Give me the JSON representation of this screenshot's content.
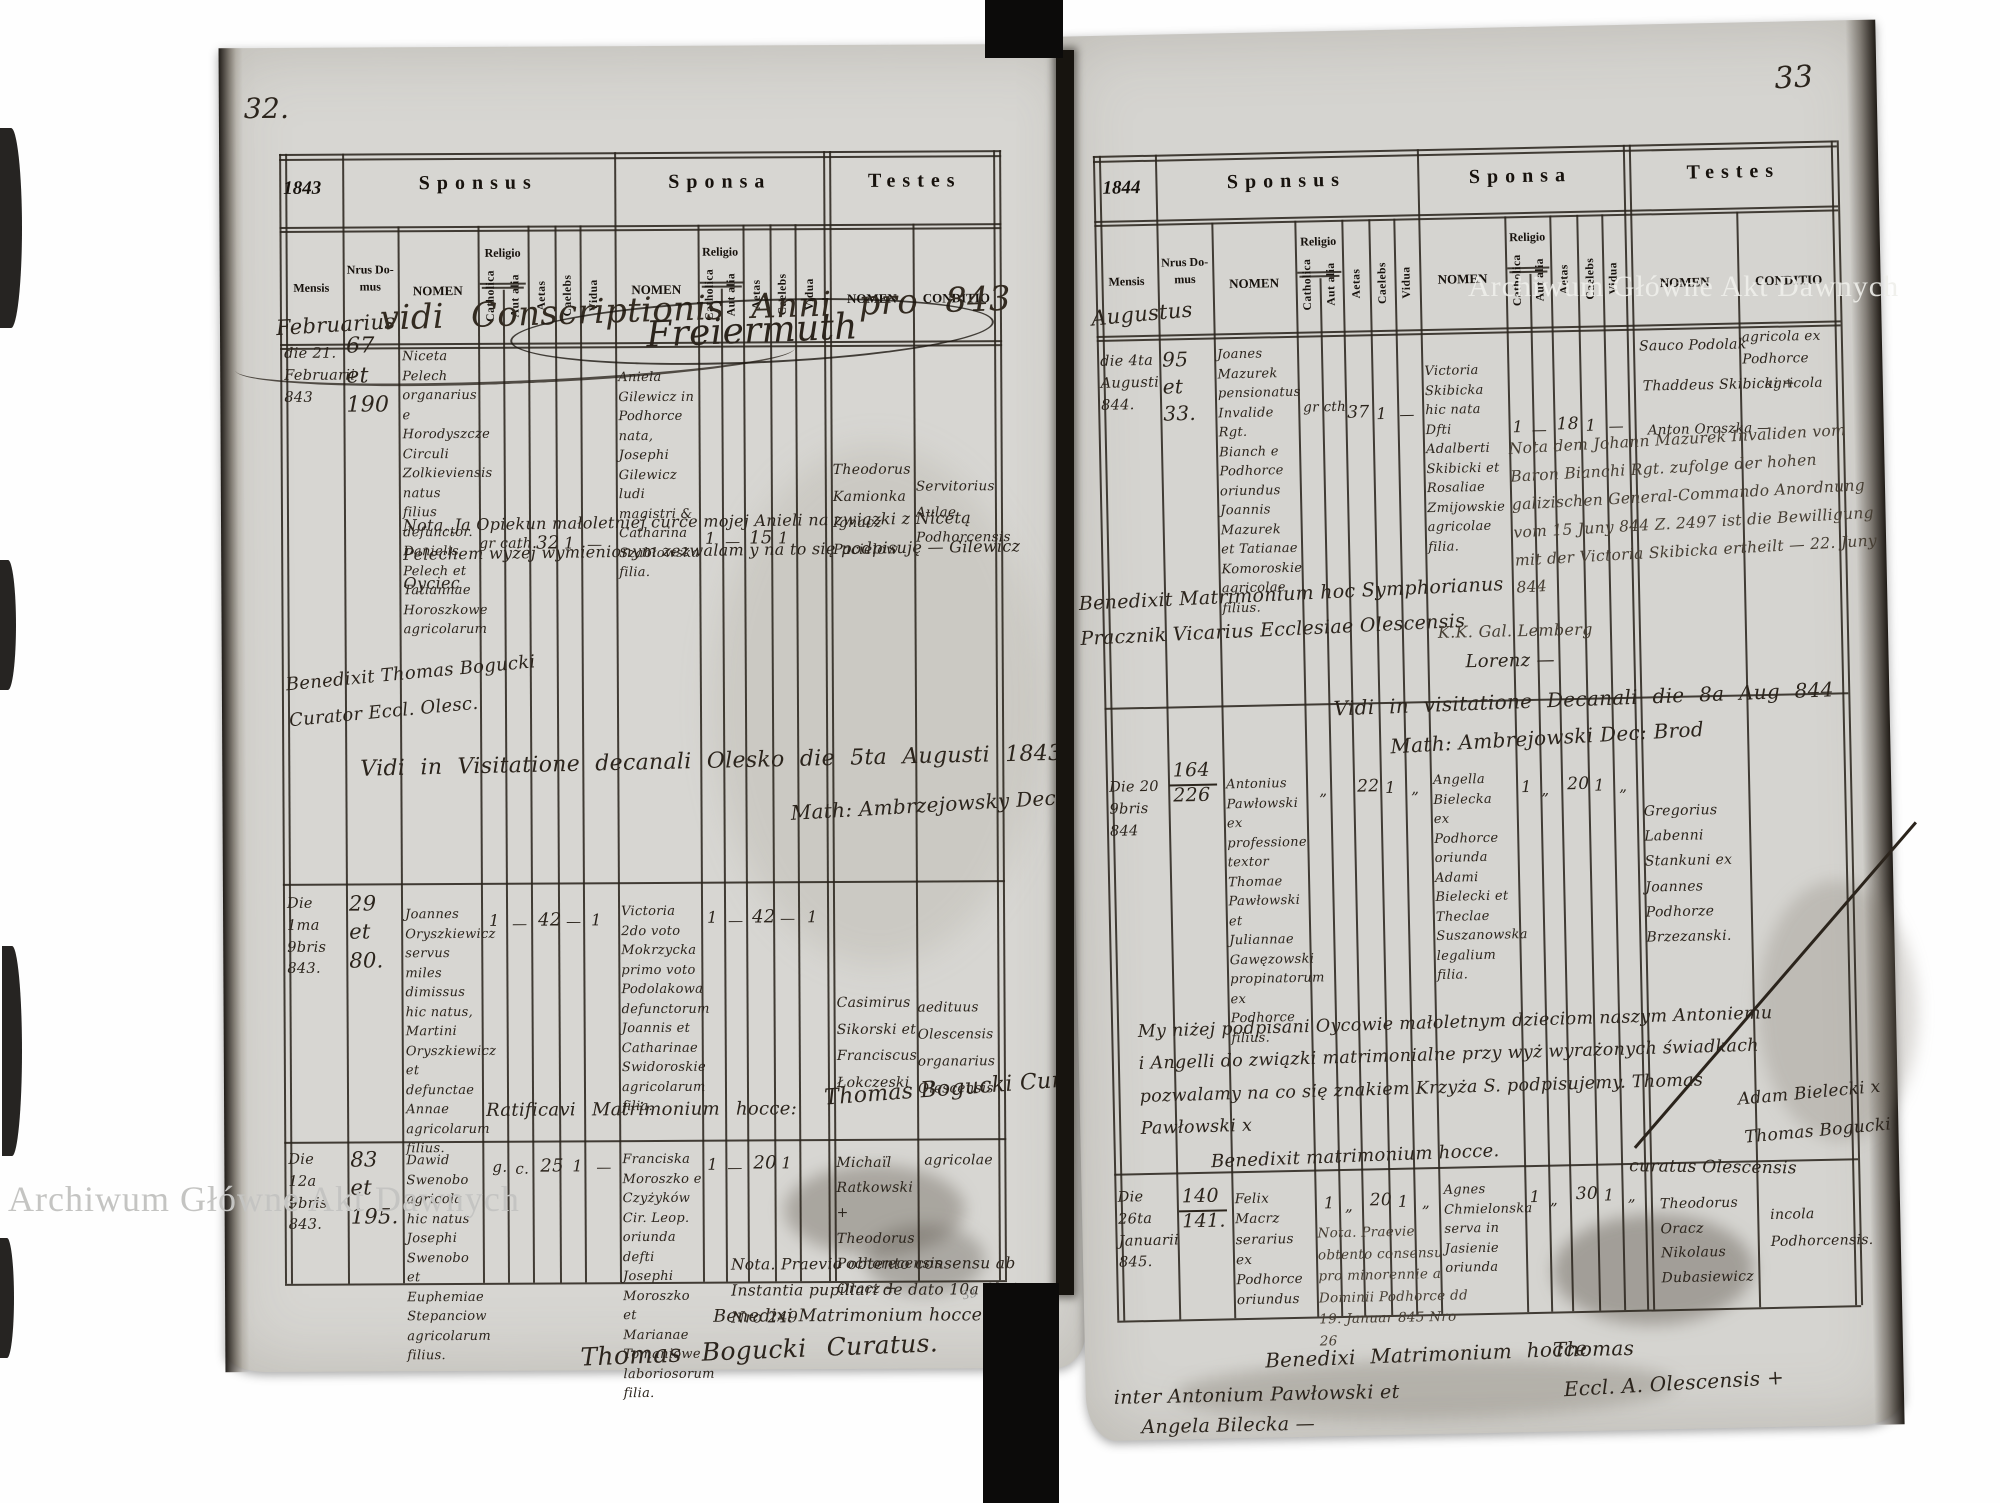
{
  "watermark": "Archiwum Główne Akt Dawnych",
  "pencil_mark": "33",
  "headers": {
    "sponsus": "Sponsus",
    "sponsa": "Sponsa",
    "testes": "Testes",
    "mensis": "Mensis",
    "nrus_domus": "Nrus Do- mus",
    "nomen": "NOMEN",
    "religio": "Religio",
    "catholica": "Catholica",
    "aut_alia": "Aut alia",
    "aetas": "Aetas",
    "caelebs": "Caelebs",
    "vidua": "Vidua",
    "conditio": "CONDITIO"
  },
  "left_page": {
    "page_number": "32.",
    "year": "1843",
    "month": "Februarius",
    "overlay_line": "vidi Conscriptionis Anni pro 843",
    "overlay_sig": "Freiermuth",
    "note_guardian": "Nota. Ja Opiekun małoletniej curce mojej Anieli na związki z Nicetą Pelechem wyżej wymienionym zezwalam y na to się podpisuję — Gilewicz Oyciec",
    "benedixit_note": "Benedixit Thomas Bogucki Curator Eccl. Olesc.",
    "vidi_line": "Vidi in Visitatione decanali Olesko die 5ta Augusti 1843.",
    "dean_sig": "Math: Ambrzejowsky Dec: Brod",
    "records": [
      {
        "date": "die 21. Februarii 843",
        "house_no": "67 et 190",
        "sponsus_name": "Niceta Pelech organarius e Horodyszcze Circuli Zolkieviensis natus filius defunctor. Danielis Pelech et Tatiannae Horoszkowe agricolarum",
        "sponsus_religio": "gr cath.",
        "sponsus_aetas": "32",
        "sponsus_caelebs": "1",
        "sponsus_vidua": "—",
        "sponsa_name": "Aniela Gilewicz in Podhorce nata, Josephi Gilewicz ludi magistri & Catharina Szabłowska filia.",
        "sponsa_catholica": "1",
        "sponsa_aut_alia": "—",
        "sponsa_aetas": "15",
        "sponsa_caelebs": "1",
        "testes_names": "Theodorus Kamionka Ignacz Pacielow",
        "testes_conditio": "Servitorius Aulae Podhorcensis"
      },
      {
        "date": "Die 1ma 9bris 843.",
        "house_no": "29 et 80.",
        "sponsus_name": "Joannes Oryszkiewicz servus miles dimissus hic natus, Martini Oryszkiewicz et defunctae Annae agricolarum filius.",
        "sponsus_catholica": "1",
        "sponsus_aut_alia": "—",
        "sponsus_aetas": "42",
        "sponsus_caelebs": "—",
        "sponsus_vidua": "1",
        "sponsa_name": "Victoria 2do voto Mokrzycka primo voto Podolakowa defunctorum Joannis et Catharinae Swidoroskie agricolarum filia.",
        "sponsa_catholica": "1",
        "sponsa_aut_alia": "—",
        "sponsa_aetas": "42",
        "sponsa_caelebs": "—",
        "sponsa_vidua": "1",
        "testes_names": "Casimirus Sikorski et Franciscus Łokczeski",
        "testes_conditio": "aedituus Olescensis organarius Olescensis",
        "ratificavi": "Ratificavi Matrimonium hocce:",
        "signature": "Thomas Bogucki Cur."
      },
      {
        "date": "Die 12a 9bris 843.",
        "house_no": "83 et 195.",
        "sponsus_name": "Dawid Swenobo agricola hic natus Josephi Swenobo et Euphemiae Stepanciow agricolarum filius.",
        "sponsus_religio_g": "g.",
        "sponsus_religio_c": "c.",
        "sponsus_aetas": "25",
        "sponsus_caelebs": "1",
        "sponsus_vidua": "—",
        "sponsa_name": "Franciska Moroszko e Czyżyków Cir. Leop. oriunda defti Josephi Moroszko et Marianae Tomaniowe laboriosorum filia.",
        "sponsa_catholica": "1",
        "sponsa_aut_alia": "—",
        "sponsa_aetas": "20",
        "sponsa_caelebs": "1",
        "testes_names": "Michaïl Ratkowski + Theodorus Pochorecensis Oracz +",
        "testes_conditio": "agricolae",
        "nota": "Nota. Praevio obtento consensu ab Instantia pupillari de dato 10a 9bris Nro 249",
        "benedixi": "Benedixi Matrimonium hocce:",
        "signature": "Thomas Bogucki Curatus."
      }
    ]
  },
  "right_page": {
    "page_number": "33",
    "year": "1844",
    "month": "Augustus",
    "records": [
      {
        "date": "die 4ta Augusti 844.",
        "house_no": "95 et 33.",
        "sponsus_name": "Joanes Mazurek pensionatus Invalide Rgt. Bianch e Podhorce oriundus Joannis Mazurek et Tatianae Komoroskie agricolae filius.",
        "sponsus_religio": "gr cth",
        "sponsus_aetas": "37",
        "sponsus_caelebs": "1",
        "sponsus_vidua": "—",
        "sponsa_name": "Victoria Skibicka hic nata Dfti Adalberti Skibicki et Rosaliae Zmijowskie agricolae filia.",
        "sponsa_catholica": "1",
        "sponsa_aut_alia": "—",
        "sponsa_aetas": "18",
        "sponsa_caelebs": "1",
        "sponsa_vidua": "—",
        "testis_1": "Sauco Podolak",
        "testis_2": "Thaddeus Skibicki +",
        "testis_3": "Anton Oroszka —",
        "conditio_1": "agricola ex Podhorce",
        "conditio_2": "agricola",
        "german_note": "Nota dem Johann Mazurek Invaliden vom Baron Bianchi Rgt. zufolge der hohen galizischen General-Commando Anordnung vom 15 Juny 844 Z. 2497 ist die Bewilligung mit der Victoria Skibicka ertheilt — 22. Juny 844",
        "kk_line": "K.K. Gal. Lemberg",
        "lorenz_sig": "Lorenz —",
        "benedixit": "Benedixit Matrimonium hoc Symphorianus Pracznik Vicarius Ecclesiae Olescensis",
        "vidi": "Vidi in visitatione Decanali die 8a Aug 844",
        "dean_sig": "Math: Ambrejowski Dec: Brod"
      },
      {
        "date": "Die 20 9bris 844",
        "house_no": "164 226",
        "sponsus_name": "Antonius Pawłowski ex professione textor Thomae Pawłowski et Juliannae Gawęzowski propinatorum ex Podhorce filius.",
        "sponsus_catholica": "„",
        "sponsus_aetas": "22",
        "sponsus_caelebs": "1",
        "sponsus_vidua": "„",
        "sponsa_name": "Angella Bielecka ex Podhorce oriunda Adami Bielecki et Theclae Suszanowska legalium filia.",
        "sponsa_catholica": "1",
        "sponsa_aut_alia": "„",
        "sponsa_aetas": "20",
        "sponsa_caelebs": "1",
        "sponsa_vidua": "„",
        "testes_names": "Gregorius Labenni Stankuni ex Joannes Podhorze Brzezanski.",
        "polish_note": "My niżej podpisani Oycowie małoletnym dzieciom naszym Antoniemu i Angelli do związki matrimonialne przy wyż wyrażonych świadkach pozwalamy na co się znakiem Krzyża S. podpisujemy. Thomas Pawłowski x",
        "benedixit": "Benedixit matrimonium hocce.",
        "side_sig_1": "Adam Bielecki x",
        "side_sig_2": "Thomas Bogucki",
        "side_sig_3": "curatus Olescensis"
      },
      {
        "date": "Die 26ta Januarii 845.",
        "house_no": "140 141.",
        "sponsus_name": "Felix Macrz serarius ex Podhorce oriundus",
        "sponsus_catholica": "1",
        "sponsus_aut_alia": "„",
        "sponsus_aetas": "20",
        "sponsus_caelebs": "1",
        "sponsus_vidua": "„",
        "nota": "Nota. Praevie obtento consensu pro minorennie a Dominii Podhorce dd 19. Januar 845 Nro 26",
        "sponsa_name": "Agnes Chmielonska serva in Jasienie oriunda",
        "sponsa_catholica": "1",
        "sponsa_aut_alia": "„",
        "sponsa_aetas": "30",
        "sponsa_caelebs": "1",
        "sponsa_vidua": "„",
        "testes_names": "Theodorus Oracz Nikolaus Dubasiewicz",
        "testes_conditio": "incola Podhorcensis.",
        "benedixi_1": "Benedixi Matrimonium hocce",
        "benedixi_2": "inter Antonium Pawłowski et",
        "benedixi_3": "Angela Bilecka —",
        "sig_1": "Thomas",
        "sig_2": "Eccl. A. Olescensis +"
      }
    ]
  }
}
